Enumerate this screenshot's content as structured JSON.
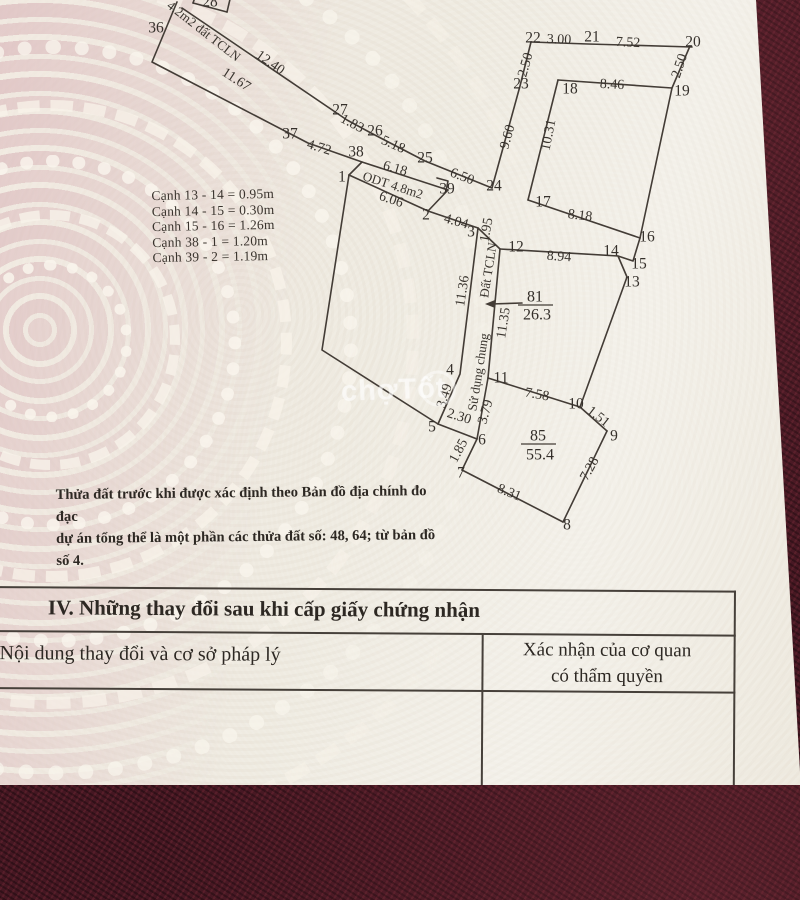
{
  "watermark": {
    "brand_text": "chợTốt"
  },
  "diagram": {
    "edges": [
      [
        [
          177,
          2
        ],
        [
          152,
          62
        ],
        [
          308,
          143
        ],
        [
          362,
          162
        ],
        [
          448,
          190
        ]
      ],
      [
        [
          182,
          8
        ],
        [
          347,
          120
        ],
        [
          371,
          133
        ],
        [
          425,
          161
        ],
        [
          492,
          188
        ]
      ],
      [
        [
          492,
          188
        ],
        [
          520,
          86
        ],
        [
          531,
          42
        ]
      ],
      [
        [
          531,
          42
        ],
        [
          588,
          44
        ],
        [
          692,
          47
        ]
      ],
      [
        [
          690,
          46
        ],
        [
          672,
          88
        ],
        [
          640,
          238
        ]
      ],
      [
        [
          558,
          80
        ],
        [
          672,
          88
        ]
      ],
      [
        [
          558,
          80
        ],
        [
          528,
          200
        ]
      ],
      [
        [
          528,
          200
        ],
        [
          640,
          238
        ]
      ],
      [
        [
          640,
          238
        ],
        [
          633,
          261
        ],
        [
          618,
          256
        ],
        [
          627,
          277
        ]
      ],
      [
        [
          627,
          277
        ],
        [
          580,
          407
        ]
      ],
      [
        [
          500,
          249
        ],
        [
          618,
          256
        ]
      ],
      [
        [
          478,
          228
        ],
        [
          500,
          249
        ]
      ],
      [
        [
          428,
          211
        ],
        [
          478,
          228
        ]
      ],
      [
        [
          349,
          175
        ],
        [
          428,
          211
        ]
      ],
      [
        [
          362,
          162
        ],
        [
          349,
          175
        ]
      ],
      [
        [
          428,
          211
        ],
        [
          448,
          190
        ]
      ],
      [
        [
          349,
          175
        ],
        [
          322,
          350
        ],
        [
          438,
          424
        ]
      ],
      [
        [
          478,
          228
        ],
        [
          460,
          374
        ],
        [
          438,
          424
        ]
      ],
      [
        [
          500,
          249
        ],
        [
          488,
          378
        ]
      ],
      [
        [
          438,
          424
        ],
        [
          477,
          439
        ]
      ],
      [
        [
          477,
          439
        ],
        [
          488,
          378
        ]
      ],
      [
        [
          488,
          378
        ],
        [
          580,
          407
        ]
      ],
      [
        [
          580,
          407
        ],
        [
          607,
          431
        ]
      ],
      [
        [
          607,
          431
        ],
        [
          563,
          522
        ]
      ],
      [
        [
          563,
          522
        ],
        [
          462,
          470
        ]
      ],
      [
        [
          462,
          470
        ],
        [
          477,
          439
        ]
      ],
      [
        [
          193,
          3
        ],
        [
          227,
          12
        ]
      ],
      [
        [
          193,
          3
        ],
        [
          197,
          -8
        ]
      ],
      [
        [
          227,
          12
        ],
        [
          231,
          -5
        ]
      ],
      [
        [
          437,
          178
        ],
        [
          448,
          181
        ],
        [
          446,
          191
        ]
      ]
    ],
    "vertex_labels": [
      {
        "t": "36",
        "x": 156,
        "y": 28
      },
      {
        "t": "37",
        "x": 290,
        "y": 134
      },
      {
        "t": "38",
        "x": 356,
        "y": 152
      },
      {
        "t": "1",
        "x": 342,
        "y": 177
      },
      {
        "t": "2",
        "x": 426,
        "y": 215
      },
      {
        "t": "3",
        "x": 471,
        "y": 232
      },
      {
        "t": "4",
        "x": 450,
        "y": 370
      },
      {
        "t": "5",
        "x": 432,
        "y": 427
      },
      {
        "t": "6",
        "x": 482,
        "y": 440
      },
      {
        "t": "7",
        "x": 461,
        "y": 473
      },
      {
        "t": "8",
        "x": 567,
        "y": 525
      },
      {
        "t": "9",
        "x": 614,
        "y": 436
      },
      {
        "t": "10",
        "x": 576,
        "y": 404
      },
      {
        "t": "11",
        "x": 501,
        "y": 378
      },
      {
        "t": "12",
        "x": 516,
        "y": 247
      },
      {
        "t": "13",
        "x": 632,
        "y": 282
      },
      {
        "t": "14",
        "x": 611,
        "y": 251
      },
      {
        "t": "15",
        "x": 639,
        "y": 264
      },
      {
        "t": "16",
        "x": 647,
        "y": 237
      },
      {
        "t": "17",
        "x": 543,
        "y": 202
      },
      {
        "t": "18",
        "x": 570,
        "y": 89
      },
      {
        "t": "19",
        "x": 682,
        "y": 91
      },
      {
        "t": "20",
        "x": 693,
        "y": 42
      },
      {
        "t": "21",
        "x": 592,
        "y": 37
      },
      {
        "t": "22",
        "x": 533,
        "y": 38
      },
      {
        "t": "23",
        "x": 521,
        "y": 84
      },
      {
        "t": "24",
        "x": 494,
        "y": 186
      },
      {
        "t": "25",
        "x": 425,
        "y": 158
      },
      {
        "t": "26",
        "x": 375,
        "y": 131
      },
      {
        "t": "27",
        "x": 340,
        "y": 110
      },
      {
        "t": "39",
        "x": 447,
        "y": 189
      },
      {
        "t": "28",
        "x": 210,
        "y": 2
      }
    ],
    "measure_labels": [
      {
        "t": "12.40",
        "x": 270,
        "y": 63,
        "r": 35
      },
      {
        "t": "11.67",
        "x": 236,
        "y": 80,
        "r": 33
      },
      {
        "t": "1.83",
        "x": 352,
        "y": 124,
        "r": 28
      },
      {
        "t": "5.18",
        "x": 393,
        "y": 145,
        "r": 24
      },
      {
        "t": "4.72",
        "x": 319,
        "y": 148,
        "r": 17
      },
      {
        "t": "6.18",
        "x": 395,
        "y": 169,
        "r": 16
      },
      {
        "t": "6.50",
        "x": 462,
        "y": 177,
        "r": 21
      },
      {
        "t": "6.06",
        "x": 391,
        "y": 200,
        "r": 19
      },
      {
        "t": "4.04",
        "x": 456,
        "y": 222,
        "r": 16
      },
      {
        "t": "1.95",
        "x": 487,
        "y": 230,
        "r": -80
      },
      {
        "t": "3.00",
        "x": 559,
        "y": 40,
        "r": 2
      },
      {
        "t": "7.52",
        "x": 628,
        "y": 43,
        "r": 3
      },
      {
        "t": "2.50",
        "x": 526,
        "y": 65,
        "r": -74
      },
      {
        "t": "2.50",
        "x": 680,
        "y": 66,
        "r": -72
      },
      {
        "t": "8.46",
        "x": 612,
        "y": 85,
        "r": 3
      },
      {
        "t": "9.60",
        "x": 508,
        "y": 137,
        "r": -74
      },
      {
        "t": "10.31",
        "x": 549,
        "y": 135,
        "r": -79
      },
      {
        "t": "8.18",
        "x": 580,
        "y": 216,
        "r": 7
      },
      {
        "t": "8.94",
        "x": 559,
        "y": 257,
        "r": 4
      },
      {
        "t": "11.36",
        "x": 463,
        "y": 291,
        "r": -81
      },
      {
        "t": "11.35",
        "x": 504,
        "y": 323,
        "r": -81
      },
      {
        "t": "7.58",
        "x": 537,
        "y": 395,
        "r": 10
      },
      {
        "t": "1.51",
        "x": 598,
        "y": 417,
        "r": 38
      },
      {
        "t": "7.28",
        "x": 590,
        "y": 469,
        "r": -61
      },
      {
        "t": "8.31",
        "x": 509,
        "y": 493,
        "r": 22
      },
      {
        "t": "1.85",
        "x": 459,
        "y": 451,
        "r": -62
      },
      {
        "t": "2.30",
        "x": 459,
        "y": 417,
        "r": 17
      },
      {
        "t": "3.49",
        "x": 445,
        "y": 396,
        "r": -73
      },
      {
        "t": "3.79",
        "x": 486,
        "y": 412,
        "r": -74
      }
    ],
    "zone_labels": [
      {
        "t": "4.2m2 đất TCLN",
        "x": 204,
        "y": 31,
        "r": 38
      },
      {
        "t": "ODT 4.8m2",
        "x": 393,
        "y": 185,
        "r": 18
      },
      {
        "t": "Đất TCLN",
        "x": 488,
        "y": 270,
        "r": -81
      },
      {
        "t": "Sử dụng chung",
        "x": 478,
        "y": 372,
        "r": -81
      }
    ],
    "plots": [
      {
        "num": "81",
        "area": "26.3",
        "nx": 535,
        "ny": 297,
        "ax": 537,
        "ay": 315,
        "ul": [
          518,
          305,
          553,
          305
        ]
      },
      {
        "num": "85",
        "area": "55.4",
        "nx": 538,
        "ny": 436,
        "ax": 540,
        "ay": 455,
        "ul": [
          521,
          444,
          556,
          444
        ]
      }
    ],
    "arrow": {
      "from": [
        522,
        303
      ],
      "to": [
        491,
        304
      ]
    },
    "notes": [
      "Cạnh 13 - 14 = 0.95m",
      "Cạnh 14 - 15 = 0.30m",
      "Cạnh 15 - 16 = 1.26m",
      "Cạnh 38 - 1 = 1.20m",
      "Cạnh 39 - 2 = 1.19m"
    ],
    "description_line1": "Thửa đất trước khi được xác định theo Bản đồ địa chính đo đạc",
    "description_line2": "dự án tổng thể là một phần các thửa đất số: 48, 64; từ bản đồ số 4."
  },
  "section4": {
    "title": "IV. Những thay đổi sau khi cấp giấy chứng nhận",
    "col_left_header": "Nội dung thay đổi và cơ sở pháp lý",
    "col_right_header_line1": "Xác nhận của cơ quan",
    "col_right_header_line2": "có thẩm quyền"
  },
  "colors": {
    "fabric": "#451722",
    "paper": "#efebe1",
    "watermark_pink": "#e2c7c7",
    "ink": "#38332d"
  }
}
